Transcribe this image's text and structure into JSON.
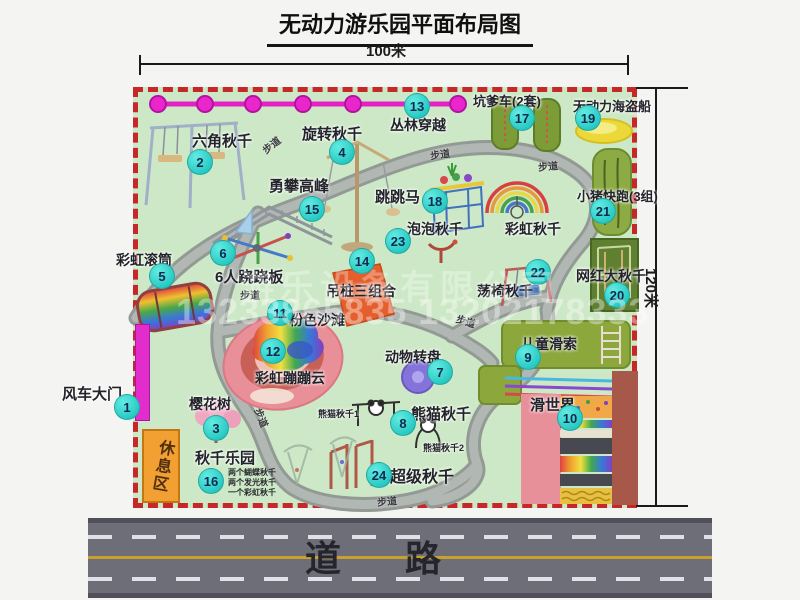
{
  "title": "无动力游乐园平面布局图",
  "dimensions": {
    "top": "100米",
    "right": "120米"
  },
  "road": {
    "label": "道　路"
  },
  "walkway_label": "步道",
  "rest_area_label": "休息区",
  "watermark": {
    "company": "游乐设备有限公司",
    "phone": "13233865835 13202178333"
  },
  "attractions": [
    {
      "num": "1",
      "name": "风车大门"
    },
    {
      "num": "2",
      "name": "六角秋千"
    },
    {
      "num": "3",
      "name": "樱花树"
    },
    {
      "num": "4",
      "name": "旋转秋千"
    },
    {
      "num": "5",
      "name": "彩虹滚筒"
    },
    {
      "num": "6",
      "name": "6人跷跷板"
    },
    {
      "num": "7",
      "name": "动物转盘"
    },
    {
      "num": "8",
      "name": "熊猫秋千"
    },
    {
      "num": "9",
      "name": "儿童滑索"
    },
    {
      "num": "10",
      "name": "滑世界"
    },
    {
      "num": "11",
      "name": "粉色沙滩"
    },
    {
      "num": "12",
      "name": "彩虹蹦蹦云"
    },
    {
      "num": "13",
      "name": "丛林穿越"
    },
    {
      "num": "14",
      "name": "吊桩三组合"
    },
    {
      "num": "15",
      "name": "勇攀高峰"
    },
    {
      "num": "16",
      "name": "秋千乐园"
    },
    {
      "num": "17",
      "name": "坑爹车(2套)"
    },
    {
      "num": "18",
      "name": "跳跳马"
    },
    {
      "num": "19",
      "name": "无动力海盗船"
    },
    {
      "num": "20",
      "name": "网红大秋千"
    },
    {
      "num": "21",
      "name": "小猪快跑(3组)"
    },
    {
      "num": "22",
      "name": "荡椅秋千"
    },
    {
      "num": "23",
      "name": "泡泡秋千"
    },
    {
      "num": "24",
      "name": "超级秋千"
    }
  ],
  "unnumbered": {
    "rainbow_swing": "彩虹秋千",
    "panda_swing_1": "熊猫秋千1",
    "panda_swing_2": "熊猫秋千2"
  },
  "swing_park_notes": [
    "两个蝴蝶秋千",
    "两个发光秋千",
    "一个彩虹秋千"
  ]
}
